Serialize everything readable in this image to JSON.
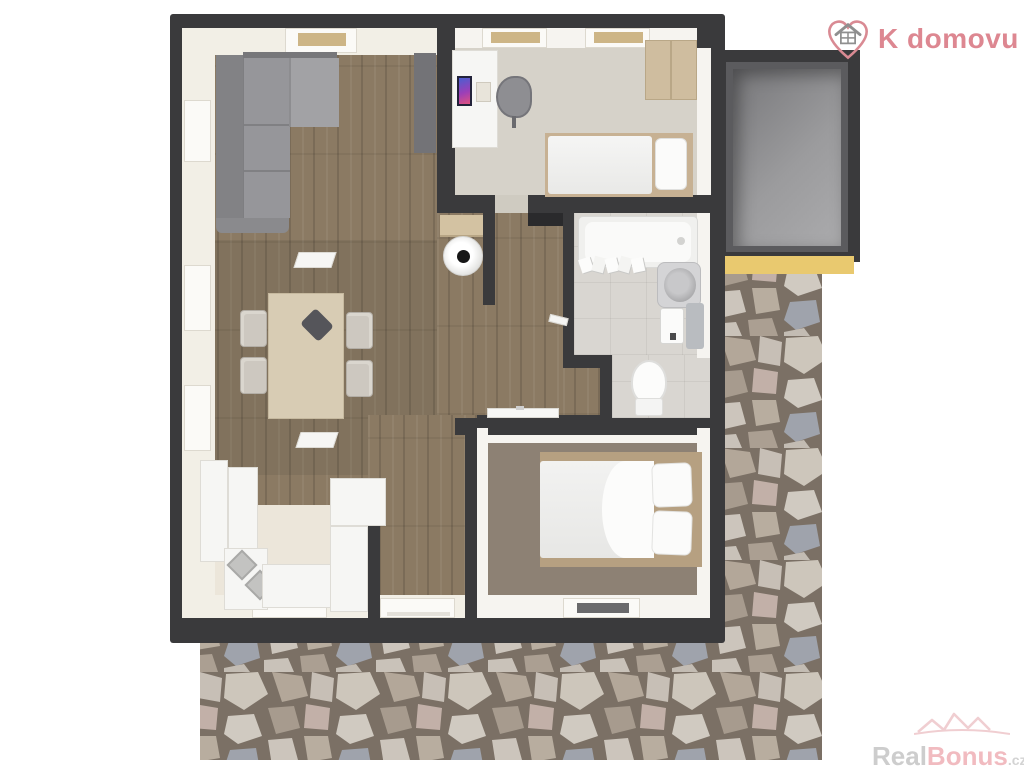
{
  "branding": {
    "logo_text": "K domovu",
    "logo_icon": "heart-house-icon"
  },
  "watermark": {
    "part1": "Real",
    "part2": "Bonus",
    "suffix": ".cz",
    "icon": "houses-outline-icon"
  },
  "colors": {
    "brand_pink": "#dd8791",
    "watermark_gray": "#c8c8c8",
    "watermark_pink": "#f0b4ba",
    "wall_dark": "#3a3a3c",
    "wood_floor": "#8b7a63",
    "carpet_office": "#d6d2c9",
    "carpet_bedroom": "#8d8174",
    "tile_bathroom": "#d9d6d1",
    "kitchen_floor": "#ece6da",
    "storage_floor": "#9b9b9d",
    "accent_yellow": "#e9c96f",
    "stone_grout": "#7b7065"
  },
  "floorplan": {
    "type": "apartment-3d-top-view",
    "rooms": [
      "living-room-with-dining",
      "kitchen",
      "entry-hall",
      "office-bedroom",
      "bathroom",
      "bedroom",
      "storage-room",
      "stone-terrace"
    ]
  }
}
